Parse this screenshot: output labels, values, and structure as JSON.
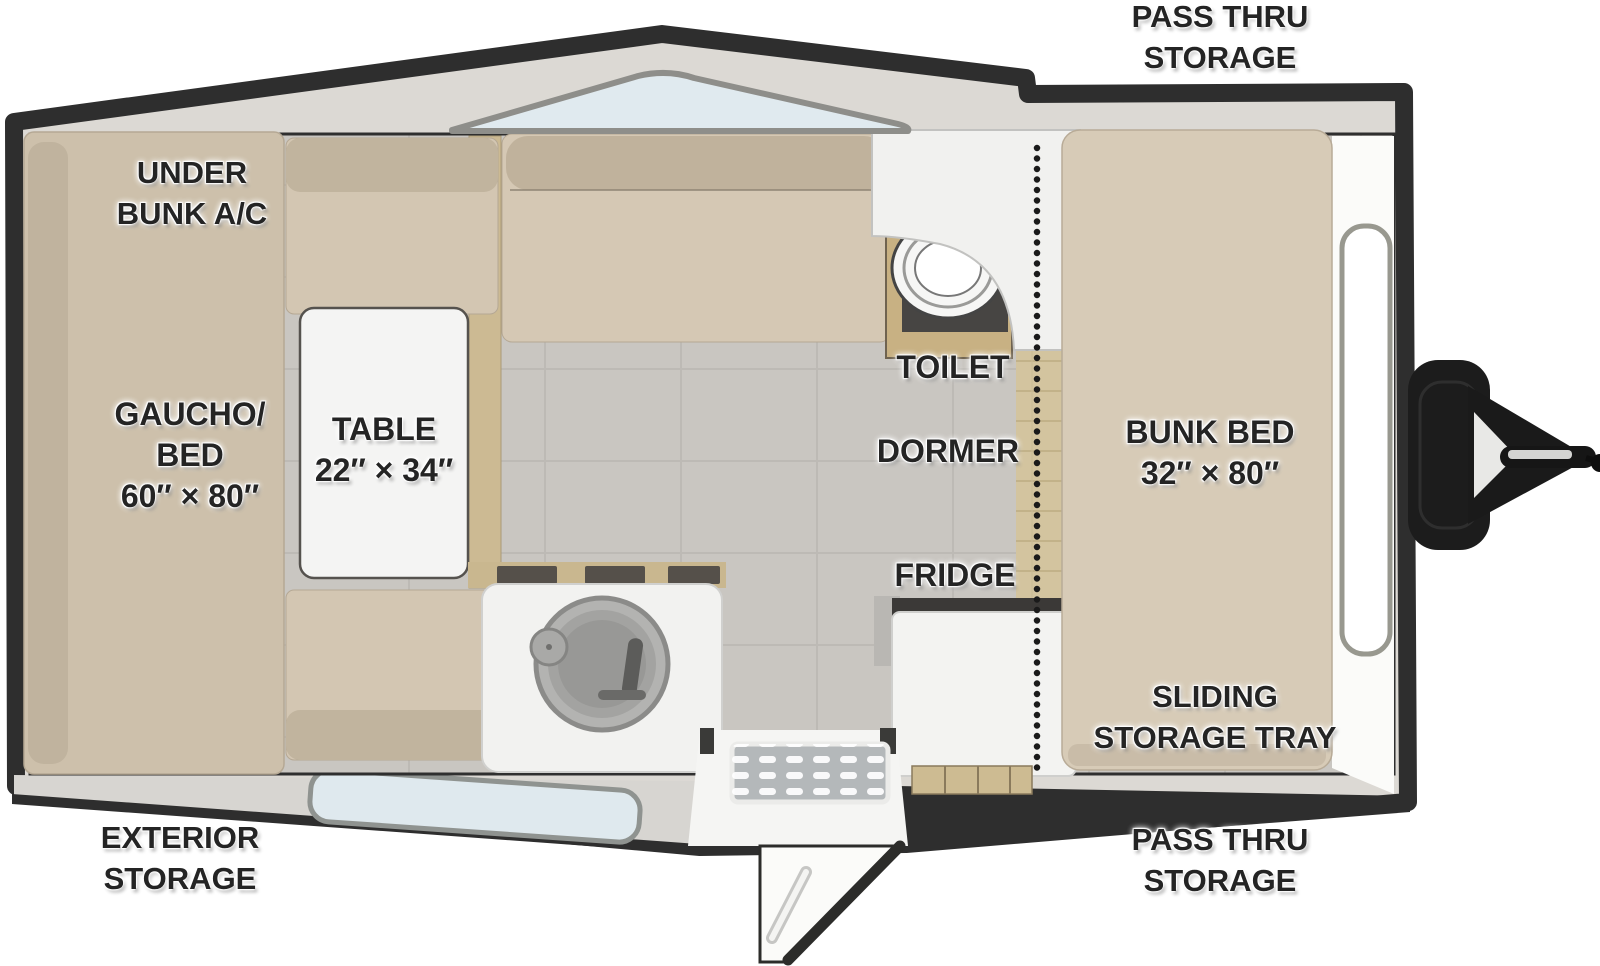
{
  "title": "A-frame camper trailer floor plan",
  "labels": {
    "pass_thru_top": [
      "PASS THRU",
      "STORAGE"
    ],
    "under_bunk_ac": [
      "UNDER",
      "BUNK A/C"
    ],
    "gaucho_bed": [
      "GAUCHO/",
      "BED",
      "60″ × 80″"
    ],
    "table": [
      "TABLE",
      "22″ × 34″"
    ],
    "toilet": [
      "TOILET"
    ],
    "dormer": [
      "DORMER"
    ],
    "bunk_bed": [
      "BUNK BED",
      "32″ × 80″"
    ],
    "fridge": [
      "FRIDGE"
    ],
    "sliding_storage_tray": [
      "SLIDING",
      "STORAGE TRAY"
    ],
    "exterior_storage": [
      "EXTERIOR",
      "STORAGE"
    ],
    "pass_thru_bottom": [
      "PASS THRU",
      "STORAGE"
    ]
  },
  "colors": {
    "shell_dark": "#2e2e2e",
    "roof_band": "#dcd9d4",
    "cushion": "#d3c6b2",
    "cushion_dark": "#c1b49e",
    "gaucho": "#cdc0ab",
    "floor_gray": "#c9c6c1",
    "wood": "#d3c49f",
    "glass_blue": "#dfe9ee",
    "fixture_white": "#f3f3f1",
    "label_text": "#242424"
  }
}
